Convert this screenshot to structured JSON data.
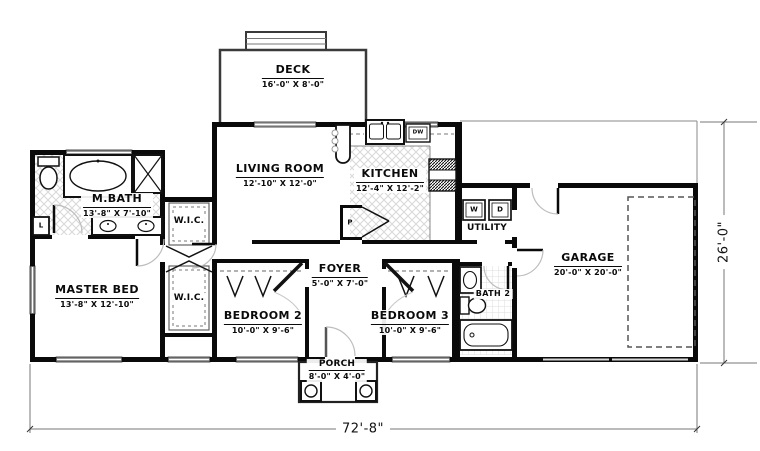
{
  "rooms": {
    "deck": {
      "name": "DECK",
      "dims": "16'-0\" X 8'-0\""
    },
    "living_room": {
      "name": "LIVING ROOM",
      "dims": "12'-10\" X 12'-0\""
    },
    "kitchen": {
      "name": "KITCHEN",
      "dims": "12'-4\" X 12'-2\""
    },
    "master_bath": {
      "name": "M.BATH",
      "dims": "13'-8\" X 7'-10\""
    },
    "master_bed": {
      "name": "MASTER BED",
      "dims": "13'-8\" X 12'-10\""
    },
    "wic_upper": {
      "name": "W.I.C."
    },
    "wic_lower": {
      "name": "W.I.C."
    },
    "foyer": {
      "name": "FOYER",
      "dims": "5'-0\" X 7'-0\""
    },
    "bedroom2": {
      "name": "BEDROOM 2",
      "dims": "10'-0\" X 9'-6\""
    },
    "bedroom3": {
      "name": "BEDROOM 3",
      "dims": "10'-0\" X 9'-6\""
    },
    "porch": {
      "name": "PORCH",
      "dims": "8'-0\" X 4'-0\""
    },
    "utility": {
      "name": "UTILITY"
    },
    "bath2": {
      "name": "BATH 2"
    },
    "garage": {
      "name": "GARAGE",
      "dims": "20'-0\" X 20'-0\""
    }
  },
  "labels": {
    "washer": "W",
    "dryer": "D",
    "dishwasher": "DW",
    "pantry": "P",
    "linen": "L"
  },
  "dimensions": {
    "overall_width": "72'-8\"",
    "overall_depth": "26'-0\""
  },
  "colors": {
    "wall": "#0a0a0a",
    "window": "#9a9a9a",
    "dimension_line": "#777777",
    "tile_line": "#d8d8d8",
    "background": "#ffffff"
  }
}
